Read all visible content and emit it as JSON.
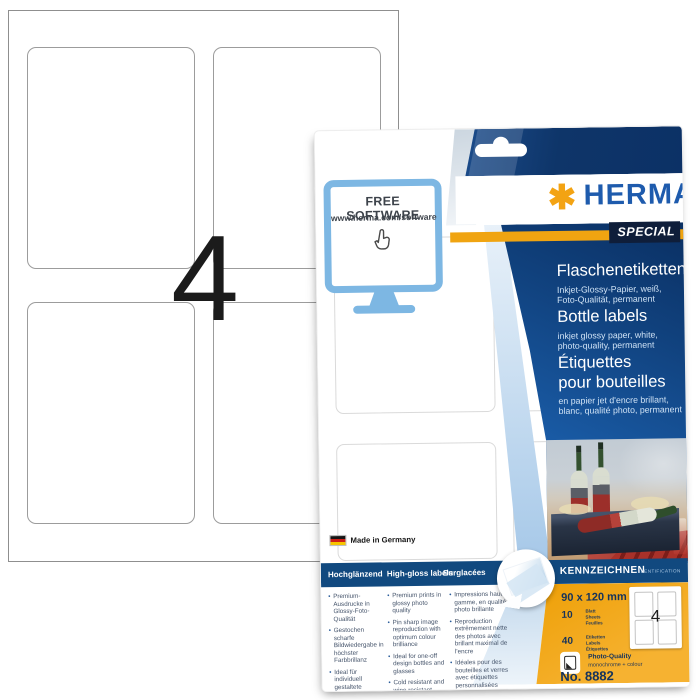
{
  "sheet": {
    "count": "4"
  },
  "package": {
    "free_software": {
      "title": "FREE SOFTWARE",
      "url": "www.herma.com/software"
    },
    "brand": {
      "mark": "✱",
      "name": "HERMA",
      "badge": "SPECIAL"
    },
    "titles": {
      "de": {
        "heading": "Flaschenetiketten",
        "sub1": "Inkjet-Glossy-Papier, weiß,",
        "sub2": "Foto-Qualität, permanent"
      },
      "en": {
        "heading": "Bottle labels",
        "sub1": "inkjet glossy paper, white,",
        "sub2": "photo-quality, permanent"
      },
      "fr": {
        "heading": "Étiquettes pour bouteilles",
        "sub1": "en papier jet d'encre brillant,",
        "sub2": "blanc, qualité photo, permanent"
      }
    },
    "made_in": "Made in Germany",
    "features": {
      "columns": [
        {
          "header": "Hochglänzend",
          "bullets": [
            "Premium-Ausdrucke in Glossy-Foto-Qualität",
            "Gestochen scharfe Bildwiedergabe in höchster Farbbrillanz",
            "Ideal für individuell gestaltete Flaschen und Gläser",
            "Kältebeständig und wischfest"
          ]
        },
        {
          "header": "High-gloss labels",
          "bullets": [
            "Premium prints in glossy photo quality",
            "Pin sharp image reproduction with optimum colour brilliance",
            "Ideal for one-off design bottles and glasses",
            "Cold resistant and wipe resistant"
          ]
        },
        {
          "header": "Surglacées",
          "bullets": [
            "Impressions haut de gamme, en qualité photo brillante",
            "Reproduction extrêmement nette des photos avec brillant maximal de l'encre",
            "Idéales pour des bouteilles et verres avec étiquettes personnalisées",
            "Résistent au froid et au frottement"
          ]
        }
      ]
    },
    "category": {
      "label": "KENNZEICHNEN",
      "sub": "IDENTIFICATION"
    },
    "specs": {
      "size": "90 x 120 mm",
      "sheets": {
        "value": "10",
        "units": [
          "Blatt",
          "Sheets",
          "Feuilles"
        ]
      },
      "labels": {
        "value": "40",
        "units": [
          "Etiketten",
          "Labels",
          "Étiquettes"
        ]
      },
      "quality": {
        "title": "Photo-Quality",
        "sub": "monochrome + colour"
      },
      "article_no": "No. 8882",
      "mini_count": "4"
    },
    "colors": {
      "brand_blue": "#1e5bad",
      "navy": "#0d3569",
      "orange": "#f0a411",
      "bar_navy": "#11497f",
      "accent_light_blue": "#7db7e3"
    }
  }
}
